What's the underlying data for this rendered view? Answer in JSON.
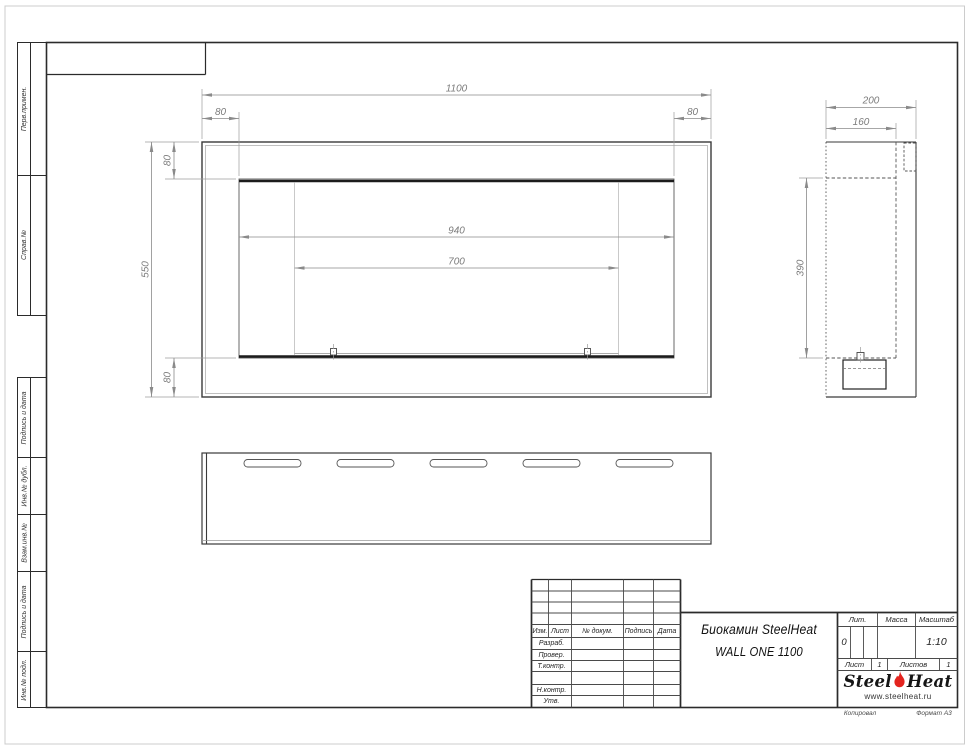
{
  "sheet": {
    "footer": {
      "copy": "Копировал",
      "format": "Формат А3"
    }
  },
  "margin": {
    "perv_primen": "Перв.примен.",
    "sprav_no": "Справ.№",
    "podpis_data_1": "Подпись и дата",
    "inv_dubl": "Инв.№ дубл.",
    "vzam_inv": "Взам.инв.№",
    "podpis_data_2": "Подпись и дата",
    "inv_podl": "Инв.№ подл."
  },
  "views": {
    "front": {
      "dims": {
        "width": "1100",
        "flange_left": "80",
        "flange_right": "80",
        "flange_top": "80",
        "height": "550",
        "flange_bottom": "80",
        "opening_width": "940",
        "burner_width": "700"
      }
    },
    "side": {
      "dims": {
        "depth": "200",
        "inner_depth": "160",
        "opening_height": "390"
      }
    }
  },
  "title_block": {
    "cols": {
      "izm": "Изм.",
      "list": "Лист",
      "doc": "№ докум.",
      "podp": "Подпись",
      "data": "Дата"
    },
    "rows": {
      "razrab": "Разраб.",
      "prover": "Провер.",
      "tkontr": "Т.контр.",
      "nkontr": "Н.контр.",
      "utv": "Утв."
    },
    "title_line1": "Биокамин SteelHeat",
    "title_line2": "WALL ONE 1100",
    "lit_label": "Лит.",
    "lit_value": "0",
    "mass_label": "Масса",
    "scale_label": "Масштаб",
    "scale_value": "1:10",
    "sheet_label": "Лист",
    "sheet_value": "1",
    "sheets_label": "Листов",
    "sheets_value": "1",
    "logo": {
      "steel": "Steel",
      "heat": "Heat",
      "url": "www.steelheat.ru"
    },
    "colors": {
      "logo_red": "#e3241f"
    }
  }
}
